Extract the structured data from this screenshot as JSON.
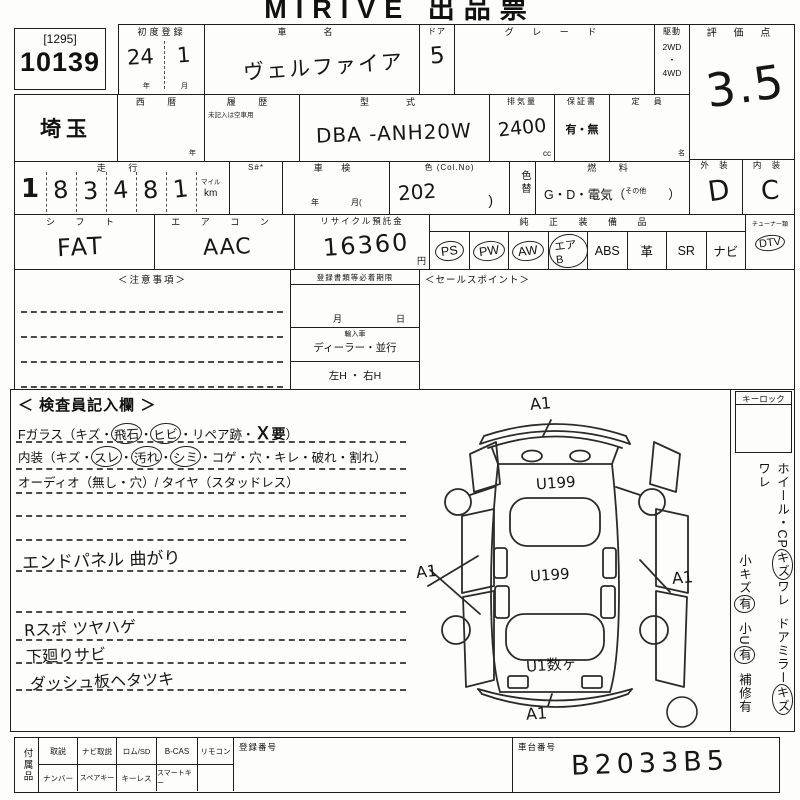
{
  "title": "MIRIVE 出品票",
  "lot": {
    "series": "[1295]",
    "number": "10139"
  },
  "header": {
    "first_reg": {
      "label": "初度登録",
      "year": "24",
      "month": "1",
      "year_unit": "年",
      "month_unit": "月"
    },
    "car_name": {
      "label": "車　名",
      "value": "ヴェルファイア"
    },
    "door": {
      "label": "ドア",
      "value": "5"
    },
    "grade": {
      "label": "グ レ ー ド"
    },
    "drive": {
      "label": "駆動",
      "opt1": "2WD",
      "sep": "・",
      "opt2": "4WD"
    },
    "score": {
      "label": "評 価 点",
      "value": "3.5"
    }
  },
  "row2": {
    "region": "埼玉",
    "seireki": {
      "label": "西 暦",
      "unit": "年"
    },
    "rireki": {
      "label": "履 歴",
      "note": "未記入は空車用"
    },
    "model": {
      "label": "型　式",
      "value": "DBA -ANH20W"
    },
    "displacement": {
      "label": "排気量",
      "value": "2400",
      "unit": "cc"
    },
    "warranty": {
      "label": "保証書",
      "options": "有・無"
    },
    "capacity": {
      "label": "定 員",
      "unit": "名"
    }
  },
  "row3": {
    "mileage": {
      "label": "走 行",
      "digits": [
        "1",
        "8",
        "3",
        "4",
        "8",
        "1"
      ],
      "unit_top": "マイル",
      "unit_bottom": "km"
    },
    "s_no": {
      "label": "S#*"
    },
    "shaken": {
      "label": "車 検",
      "year_unit": "年",
      "month_unit": "月("
    },
    "color": {
      "label": "色 (Col.No)",
      "value": "202",
      "paren": ")"
    },
    "color_change": {
      "label": "色替"
    },
    "fuel": {
      "label": "燃 料",
      "value": "G・D・電気（",
      "other": "その他",
      "close": "）"
    },
    "exterior": {
      "label": "外 装",
      "value": "D"
    },
    "interior": {
      "label": "内 装",
      "value": "C"
    }
  },
  "row4": {
    "shift": {
      "label": "シ フ ト",
      "value": "FAT"
    },
    "aircon": {
      "label": "エ ア コ ン",
      "value": "AAC"
    },
    "recycle": {
      "label": "リサイクル預託金",
      "value": "16360",
      "unit": "円"
    },
    "equipment": {
      "label": "純 正 装 備 品",
      "items": [
        {
          "label": "PS",
          "circled": true
        },
        {
          "label": "PW",
          "circled": true
        },
        {
          "label": "AW",
          "circled": true
        },
        {
          "label": "エアB",
          "circled": true
        },
        {
          "label": "ABS",
          "circled": false
        },
        {
          "label": "革",
          "circled": false
        },
        {
          "label": "SR",
          "circled": false
        },
        {
          "label": "ナビ",
          "circled": false
        }
      ]
    },
    "tuner": {
      "label": "チューナー類",
      "value": "DTV",
      "circled": true
    }
  },
  "row5": {
    "notes_label": "＜注意事項＞",
    "docs": {
      "header": "登録書類等必着期限",
      "month": "月",
      "day": "日",
      "import_label": "輸入車",
      "import_options": "ディーラー・並行",
      "steering": "左H ・ 右H"
    },
    "sales_label": "＜セールスポイント＞"
  },
  "inspector": {
    "header": "＜ 検査員記入欄 ＞",
    "fglass": {
      "p1": "Fガラス（キズ・",
      "c1": "飛石",
      "s1": "・",
      "c2": "ヒビ",
      "p2": "・リペア跡・",
      "x": "Ｘ",
      "x2": "要",
      "p3": "）"
    },
    "naiso": {
      "p1": "内装（キズ・",
      "c1": "スレ",
      "s1": "・",
      "c2": "汚れ",
      "s2": "・",
      "c3": "シミ",
      "p2": "・コゲ・穴・キレ・破れ・割れ）"
    },
    "audio": "オーディオ（無し・穴）/ タイヤ（スタッドレス）",
    "hand1": "エンドパネル 曲がり",
    "hand2": "Rスポ ツヤハゲ",
    "hand3": "下廻りサビ",
    "hand4": "ダッシュ板ヘタツキ"
  },
  "diagram": {
    "front": "A1",
    "hood": "U199",
    "roof": "U199",
    "rear": "U1数ヶ",
    "left": "A1",
    "right": "A1",
    "bottom": "A1"
  },
  "side": {
    "keylock": "キーロック",
    "col1": {
      "a": "ホイール・CP",
      "b": "キズ",
      "c": "ワレ",
      "d": "ドアミラー",
      "e": "キズ",
      "f": "ワレ"
    },
    "col2": {
      "a": "小キズ",
      "b": "有",
      "c": "小U",
      "d": "有",
      "e": "補修有"
    }
  },
  "bottom": {
    "acc_label": "付属品",
    "row1": [
      "取説",
      "ナビ取説",
      "ロム/SD",
      "B-CAS",
      "リモコン"
    ],
    "row2": [
      "ナンバー",
      "スペアキー",
      "キーレス",
      "スマートキー"
    ],
    "reg_label": "登録番号",
    "chassis_label": "車台番号",
    "chassis_value": "B2033B5"
  }
}
